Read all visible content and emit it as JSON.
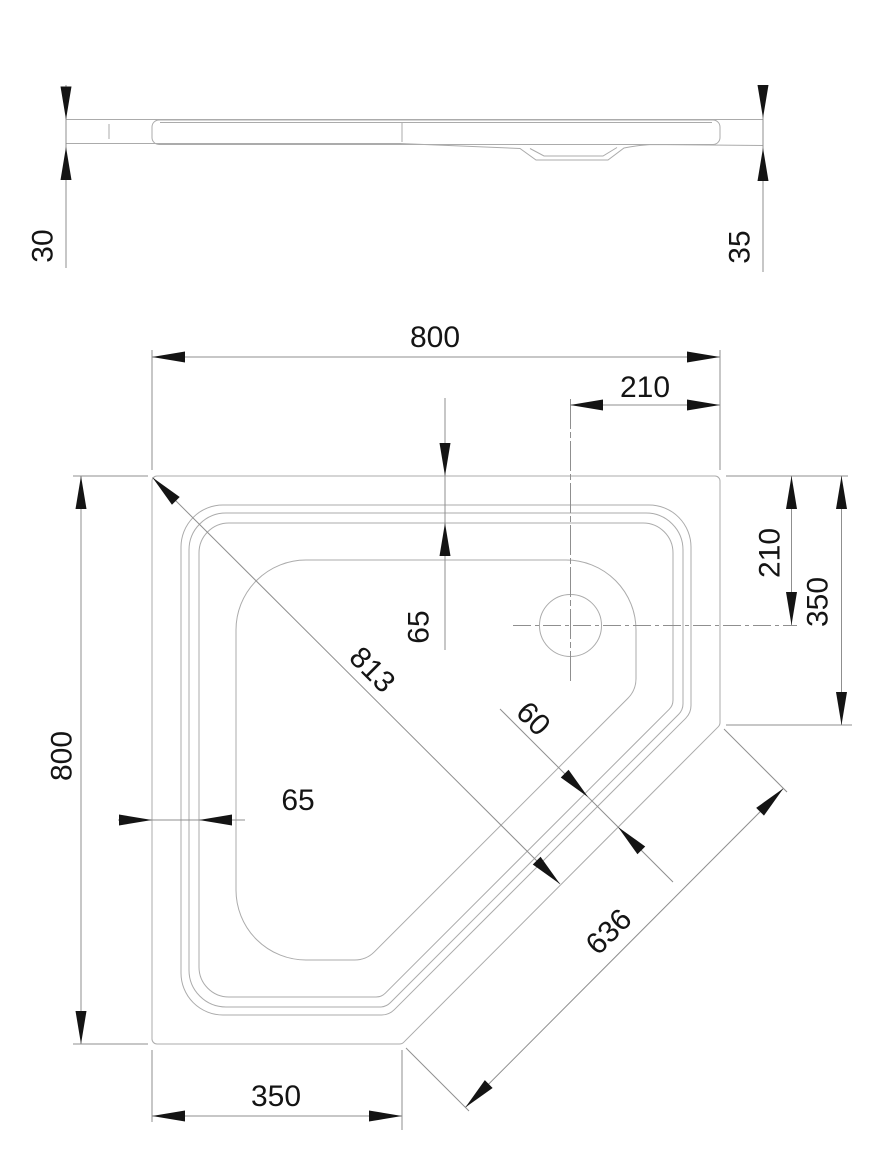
{
  "drawing": {
    "type": "technical-drawing-pentagonal-shower-tray",
    "background_color": "#ffffff",
    "contour_line_color": "#ababab",
    "dimension_line_color": "#8f8f8f",
    "text_color": "#141414",
    "views": {
      "side_profile": {
        "labels": {
          "left_height": "30",
          "right_height": "35"
        }
      },
      "plan": {
        "labels": {
          "top_width": "800",
          "top_right_offset": "210",
          "right_upper": "210",
          "right_full": "350",
          "left_height": "800",
          "bottom_width": "350",
          "edge_inset_left": "65",
          "edge_inset_top": "65",
          "diagonal_corner": "813",
          "diagonal_rim": "60",
          "diagonal_edge": "636"
        }
      }
    }
  }
}
